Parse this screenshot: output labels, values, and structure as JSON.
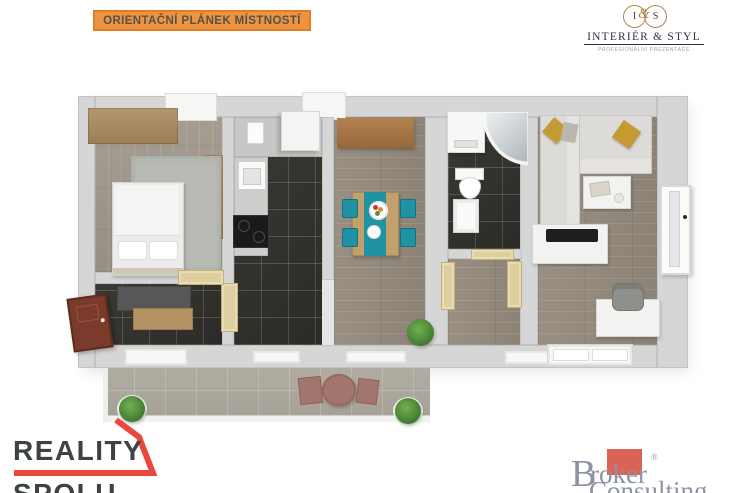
{
  "header": {
    "banner": {
      "label": "ORIENTAČNÍ PLÁNEK MÍSTNOSTÍ",
      "bg_color": "#ee9340",
      "border_color": "#e07e27",
      "text_color": "#56524a"
    },
    "interier_styl": {
      "monogram_i": "I",
      "monogram_amp": "&",
      "monogram_s": "S",
      "name": "INTERIÉR & STYL",
      "tagline": "PROFESIONÁLNÍ PREZENTACE",
      "gold_color": "#b5854b",
      "navy_color": "#2e3442"
    }
  },
  "floorplan": {
    "rooms": [
      "bedroom",
      "entry-hall",
      "kitchen",
      "dining-room",
      "bathroom",
      "inner-hallway",
      "living-room",
      "terrace"
    ],
    "furniture": [
      "wardrobe",
      "double-bed",
      "area-rug",
      "hall-bench",
      "entrance-door",
      "kitchen-counter",
      "kitchen-sink",
      "cooktop",
      "fridge",
      "water-heater",
      "sideboard",
      "dining-table",
      "dining-chairs",
      "washing-machine",
      "corner-shower",
      "toilet",
      "washbasin",
      "corner-sofa",
      "sofa-pillows",
      "coffee-table",
      "tv-stand",
      "tv",
      "desk",
      "office-chair",
      "balcony-door",
      "terrace-table",
      "terrace-chairs",
      "potted-plants"
    ],
    "accent_colors": {
      "dining_chairs": "#1f93a4",
      "sofa_pillows": "#c49a33",
      "terrace_furniture": "#a3766d",
      "dark_tile_floor": "#34322e",
      "wood_floor": "#938a7d",
      "entrance_door": "#7a3b2b",
      "interior_doors": "#decf9f"
    }
  },
  "footer": {
    "reality_spolu": {
      "line1": "REALITY",
      "line2": "SPOLU",
      "text_color": "#3d4243",
      "accent_color": "#e8493c"
    },
    "broker_consulting": {
      "initial": "B",
      "word1_rest": "roker",
      "word2": "Consulting",
      "reg_mark": "®",
      "text_color": "#8d93a1",
      "accent_color": "#da6355"
    }
  }
}
